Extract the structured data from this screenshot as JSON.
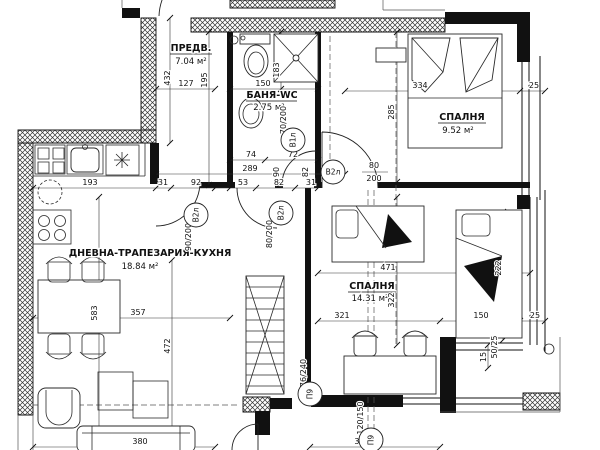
{
  "drawing": {
    "type": "architectural floor plan",
    "language": "Bulgarian",
    "line_color": "#111111",
    "background": "#ffffff"
  },
  "rooms": [
    {
      "name": "ПРЕДВ.",
      "area": "7.04 м²"
    },
    {
      "name": "БАНЯ-WC",
      "area": "2.75 м²"
    },
    {
      "name": "СПАЛНЯ",
      "area": "9.52 м²"
    },
    {
      "name": "ДНЕВНА-ТРАПЕЗАРИЯ-КУХНЯ",
      "area": "18.84 м²"
    },
    {
      "name": "СПАЛНЯ",
      "area": "14.31 м²"
    }
  ],
  "dimensions": [
    {
      "t": "432",
      "x": 170,
      "y": 78,
      "r": -90
    },
    {
      "t": "127",
      "x": 186,
      "y": 86
    },
    {
      "t": "195",
      "x": 207,
      "y": 80,
      "r": -90
    },
    {
      "t": "150",
      "x": 263,
      "y": 86
    },
    {
      "t": "183",
      "x": 279,
      "y": 70,
      "r": -90
    },
    {
      "t": "334",
      "x": 420,
      "y": 88
    },
    {
      "t": "25",
      "x": 534,
      "y": 88
    },
    {
      "t": "285",
      "x": 394,
      "y": 112,
      "r": -90
    },
    {
      "t": "74",
      "x": 251,
      "y": 157
    },
    {
      "t": "72",
      "x": 293,
      "y": 157
    },
    {
      "t": "289",
      "x": 250,
      "y": 171
    },
    {
      "t": "90",
      "x": 279,
      "y": 172,
      "r": -90
    },
    {
      "t": "82",
      "x": 308,
      "y": 172,
      "r": -90
    },
    {
      "t": "193",
      "x": 90,
      "y": 185
    },
    {
      "t": "31",
      "x": 163,
      "y": 185
    },
    {
      "t": "92",
      "x": 196,
      "y": 185
    },
    {
      "t": "53",
      "x": 243,
      "y": 185
    },
    {
      "t": "82",
      "x": 279,
      "y": 185
    },
    {
      "t": "31",
      "x": 311,
      "y": 185
    },
    {
      "t": "80",
      "x": 374,
      "y": 168
    },
    {
      "t": "200",
      "x": 374,
      "y": 181
    },
    {
      "t": "80/200",
      "x": 272,
      "y": 234,
      "r": -90
    },
    {
      "t": "90/200",
      "x": 191,
      "y": 237,
      "r": -90
    },
    {
      "t": "70/200",
      "x": 286,
      "y": 120,
      "r": -90
    },
    {
      "t": "471",
      "x": 388,
      "y": 270
    },
    {
      "t": "322",
      "x": 394,
      "y": 300,
      "r": -90
    },
    {
      "t": "222",
      "x": 501,
      "y": 268,
      "r": -90
    },
    {
      "t": "321",
      "x": 342,
      "y": 318
    },
    {
      "t": "150",
      "x": 481,
      "y": 318
    },
    {
      "t": "25",
      "x": 535,
      "y": 318
    },
    {
      "t": "357",
      "x": 138,
      "y": 315
    },
    {
      "t": "583",
      "x": 97,
      "y": 313,
      "r": -90
    },
    {
      "t": "472",
      "x": 170,
      "y": 346,
      "r": -90
    },
    {
      "t": "380",
      "x": 140,
      "y": 444
    },
    {
      "t": "320",
      "x": 362,
      "y": 444
    },
    {
      "t": "15",
      "x": 486,
      "y": 357,
      "r": -90
    },
    {
      "t": "50/25",
      "x": 497,
      "y": 347,
      "r": -90
    },
    {
      "t": "120/150",
      "x": 363,
      "y": 418,
      "r": -90
    },
    {
      "t": "76/240",
      "x": 306,
      "y": 373,
      "r": -90
    }
  ],
  "tags": [
    {
      "label": "В2л",
      "x": 333,
      "y": 172,
      "r": 0
    },
    {
      "label": "В2л",
      "x": 281,
      "y": 213,
      "r": -90
    },
    {
      "label": "В2л",
      "x": 196,
      "y": 215,
      "r": -90
    },
    {
      "label": "В1л",
      "x": 293,
      "y": 140,
      "r": -90
    },
    {
      "label": "П9",
      "x": 310,
      "y": 394,
      "r": -90
    },
    {
      "label": "П9",
      "x": 371,
      "y": 440,
      "r": -90
    }
  ]
}
